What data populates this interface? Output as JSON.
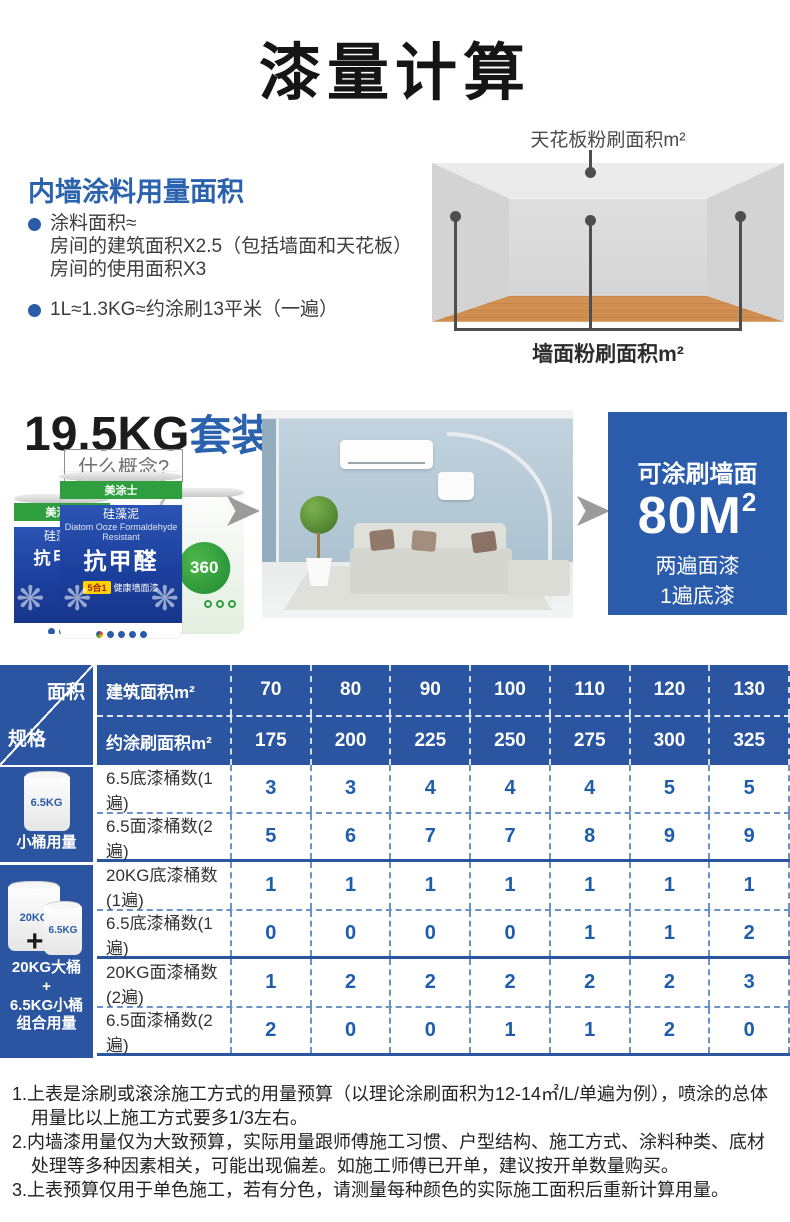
{
  "page_title": "漆量计算",
  "colors": {
    "accent_blue": "#2b55a0",
    "value_blue": "#1f5dab",
    "brand_green": "#2f9e3f",
    "result_box_blue": "#2b5cab"
  },
  "usage_section": {
    "heading": "内墙涂料用量面积",
    "bullet1_line1": "涂料面积≈",
    "bullet1_line2": "房间的建筑面积X2.5（包括墙面和天花板）",
    "bullet1_line3": "房间的使用面积X3",
    "bullet2": "1L≈1.3KG≈约涂刷13平米（一遍）"
  },
  "room_diagram": {
    "ceiling_label": "天花板粉刷面积m²",
    "wall_label": "墙面粉刷面积m²"
  },
  "kit_section": {
    "title_black": "19.5KG",
    "title_blue": "套装",
    "question": "什么概念?",
    "bucket": {
      "brand": "美涂士",
      "name_cn": "硅藻泥",
      "name_big": "抗甲醛",
      "name_en": "Diatom Ooze Formaldehyde Resistant",
      "badge": "5合1",
      "badge_sub": "健康墙面漆",
      "back_badge": "360",
      "back_small_label": "6.5KG"
    },
    "result": {
      "line1": "可涂刷墙面",
      "area": "80M",
      "area_sup": "2",
      "line2": "两遍面漆",
      "line3": "1遍底漆"
    }
  },
  "table": {
    "corner_top": "面积",
    "corner_bottom": "规格",
    "header_rows": [
      {
        "label": "建筑面积m²",
        "values": [
          "70",
          "80",
          "90",
          "100",
          "110",
          "120",
          "130"
        ]
      },
      {
        "label": "约涂刷面积m²",
        "values": [
          "175",
          "200",
          "225",
          "250",
          "275",
          "300",
          "325"
        ]
      }
    ],
    "side1": {
      "bucket_label": "6.5KG",
      "caption": "小桶用量"
    },
    "side2": {
      "bucket_big_label": "20KG",
      "bucket_small_label": "6.5KG",
      "plus": "+",
      "caption_line1": "20KG大桶",
      "caption_line2": "+",
      "caption_line3": "6.5KG小桶",
      "caption_line4": "组合用量"
    },
    "pairs": [
      {
        "rows": [
          {
            "label": "6.5底漆桶数(1遍)",
            "values": [
              "3",
              "3",
              "4",
              "4",
              "4",
              "5",
              "5"
            ]
          },
          {
            "label": "6.5面漆桶数(2遍)",
            "values": [
              "5",
              "6",
              "7",
              "7",
              "8",
              "9",
              "9"
            ]
          }
        ]
      },
      {
        "rows": [
          {
            "label": "20KG底漆桶数(1遍)",
            "values": [
              "1",
              "1",
              "1",
              "1",
              "1",
              "1",
              "1"
            ]
          },
          {
            "label": "6.5底漆桶数(1遍)",
            "values": [
              "0",
              "0",
              "0",
              "0",
              "1",
              "1",
              "2"
            ]
          }
        ]
      },
      {
        "rows": [
          {
            "label": "20KG面漆桶数(2遍)",
            "values": [
              "1",
              "2",
              "2",
              "2",
              "2",
              "2",
              "3"
            ]
          },
          {
            "label": "6.5面漆桶数(2遍)",
            "values": [
              "2",
              "0",
              "0",
              "1",
              "1",
              "2",
              "0"
            ]
          }
        ]
      }
    ]
  },
  "notes": [
    "1.上表是涂刷或滚涂施工方式的用量预算（以理论涂刷面积为12-14㎡/L/单遍为例），喷涂的总体用量比以上施工方式要多1/3左右。",
    "2.内墙漆用量仅为大致预算，实际用量跟师傅施工习惯、户型结构、施工方式、涂料种类、底材处理等多种因素相关，可能出现偏差。如施工师傅已开单，建议按开单数量购买。",
    "3.上表预算仅用于单色施工，若有分色，请测量每种颜色的实际施工面积后重新计算用量。"
  ]
}
